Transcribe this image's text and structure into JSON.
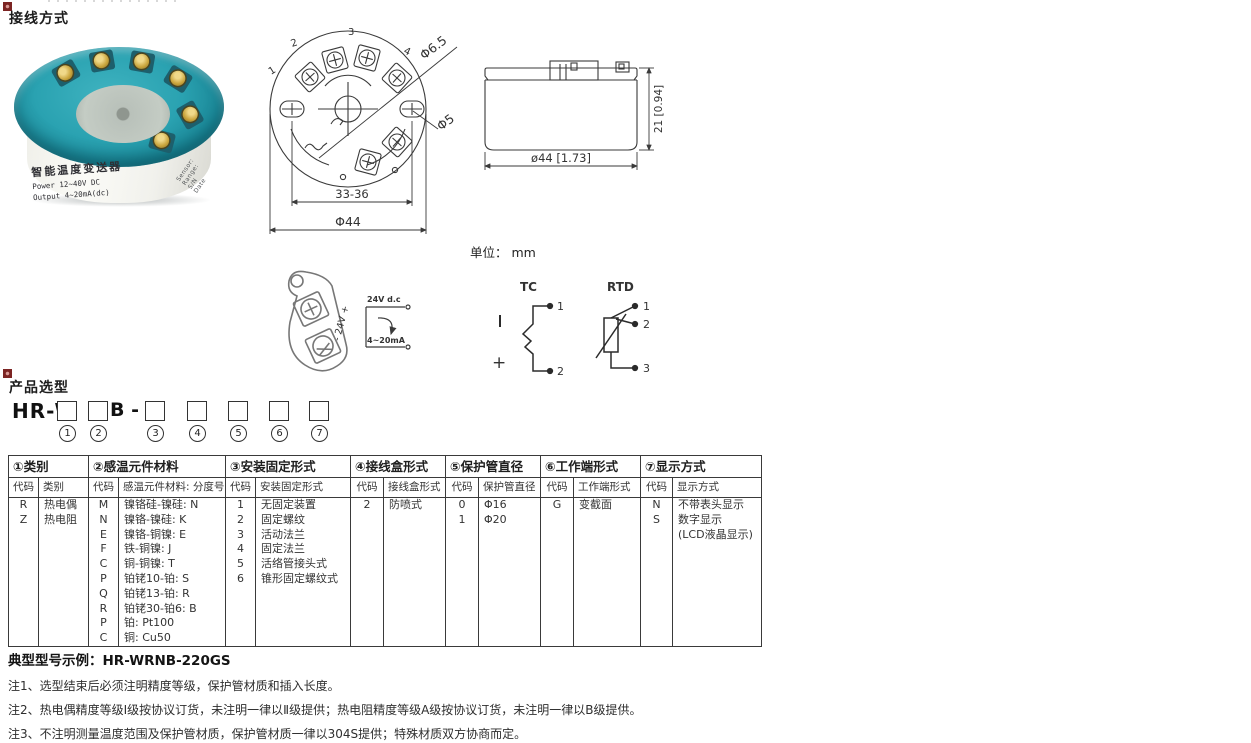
{
  "sections": {
    "wiring_title": "接线方式",
    "selection_title": "产品选型"
  },
  "unit_label": "单位： mm",
  "photo": {
    "label_title": "智能温度变送器",
    "label_line1": "Power  12~40V DC",
    "label_line2": "Output 4~20mA(dc)",
    "side_lines": [
      "Sensor:",
      "Range:",
      "S/N",
      "Date"
    ]
  },
  "top_view": {
    "terminals": [
      "1",
      "2",
      "3",
      "4"
    ],
    "dim_hole_large": "Φ6.5",
    "dim_hole_small": "Φ5",
    "dim_span": "33-36",
    "dim_diameter": "Φ44"
  },
  "side_view": {
    "dim_width": "ø44 [1.73]",
    "dim_height": "21 [0.94]"
  },
  "wiring": {
    "lug_label": "- 24V +",
    "supply_label": "24V d.c",
    "current_label": "4~20mA",
    "tc": {
      "title": "TC",
      "t1": "1",
      "t2": "2",
      "pos": "+"
    },
    "rtd": {
      "title": "RTD",
      "t1": "1",
      "t2": "2",
      "t3": "3"
    }
  },
  "model": {
    "prefix": "HR-W",
    "mid": "B -",
    "positions": [
      "1",
      "2",
      "3",
      "4",
      "5",
      "6",
      "7"
    ]
  },
  "table": {
    "groups": [
      {
        "title": "①类别",
        "code_header": "代码",
        "desc_header": "类别",
        "rows": [
          [
            "R",
            "热电偶"
          ],
          [
            "Z",
            "热电阻"
          ]
        ]
      },
      {
        "title": "②感温元件材料",
        "code_header": "代码",
        "desc_header": "感温元件材料: 分度号",
        "rows": [
          [
            "M",
            "镍铬硅-镍硅: N"
          ],
          [
            "N",
            "镍铬-镍硅: K"
          ],
          [
            "E",
            "镍铬-铜镍: E"
          ],
          [
            "F",
            "铁-铜镍: J"
          ],
          [
            "C",
            "铜-铜镍: T"
          ],
          [
            "P",
            "铂铑10-铂: S"
          ],
          [
            "Q",
            "铂铑13-铂: R"
          ],
          [
            "R",
            "铂铑30-铂6: B"
          ],
          [
            "P",
            "铂: Pt100"
          ],
          [
            "C",
            "铜: Cu50"
          ]
        ]
      },
      {
        "title": "③安装固定形式",
        "code_header": "代码",
        "desc_header": "安装固定形式",
        "rows": [
          [
            "1",
            "无固定装置"
          ],
          [
            "2",
            "固定螺纹"
          ],
          [
            "3",
            "活动法兰"
          ],
          [
            "4",
            "固定法兰"
          ],
          [
            "5",
            "活络管接头式"
          ],
          [
            "6",
            "锥形固定螺纹式"
          ]
        ]
      },
      {
        "title": "④接线盒形式",
        "code_header": "代码",
        "desc_header": "接线盒形式",
        "rows": [
          [
            "2",
            "防喷式"
          ]
        ]
      },
      {
        "title": "⑤保护管直径",
        "code_header": "代码",
        "desc_header": "保护管直径",
        "rows": [
          [
            "0",
            "Φ16"
          ],
          [
            "1",
            "Φ20"
          ]
        ]
      },
      {
        "title": "⑥工作端形式",
        "code_header": "代码",
        "desc_header": "工作端形式",
        "rows": [
          [
            "G",
            "变截面"
          ]
        ]
      },
      {
        "title": "⑦显示方式",
        "code_header": "代码",
        "desc_header": "显示方式",
        "rows": [
          [
            "N",
            "不带表头显示"
          ],
          [
            "S",
            "数字显示"
          ],
          [
            "",
            "(LCD液晶显示)"
          ]
        ]
      }
    ]
  },
  "example": "典型型号示例：HR-WRNB-220GS",
  "notes": [
    "注1、选型结束后必须注明精度等级，保护管材质和插入长度。",
    "注2、热电偶精度等级I级按协议订货，未注明一律以Ⅱ级提供；热电阻精度等级A级按协议订货，未注明一律以B级提供。",
    "注3、不注明测量温度范围及保护管材质，保护管材质一律以304S提供；特殊材质双方协商而定。"
  ],
  "colors": {
    "accent_red": "#7c2423",
    "line": "#3a3a3a",
    "teal": "#2aa2b1"
  }
}
